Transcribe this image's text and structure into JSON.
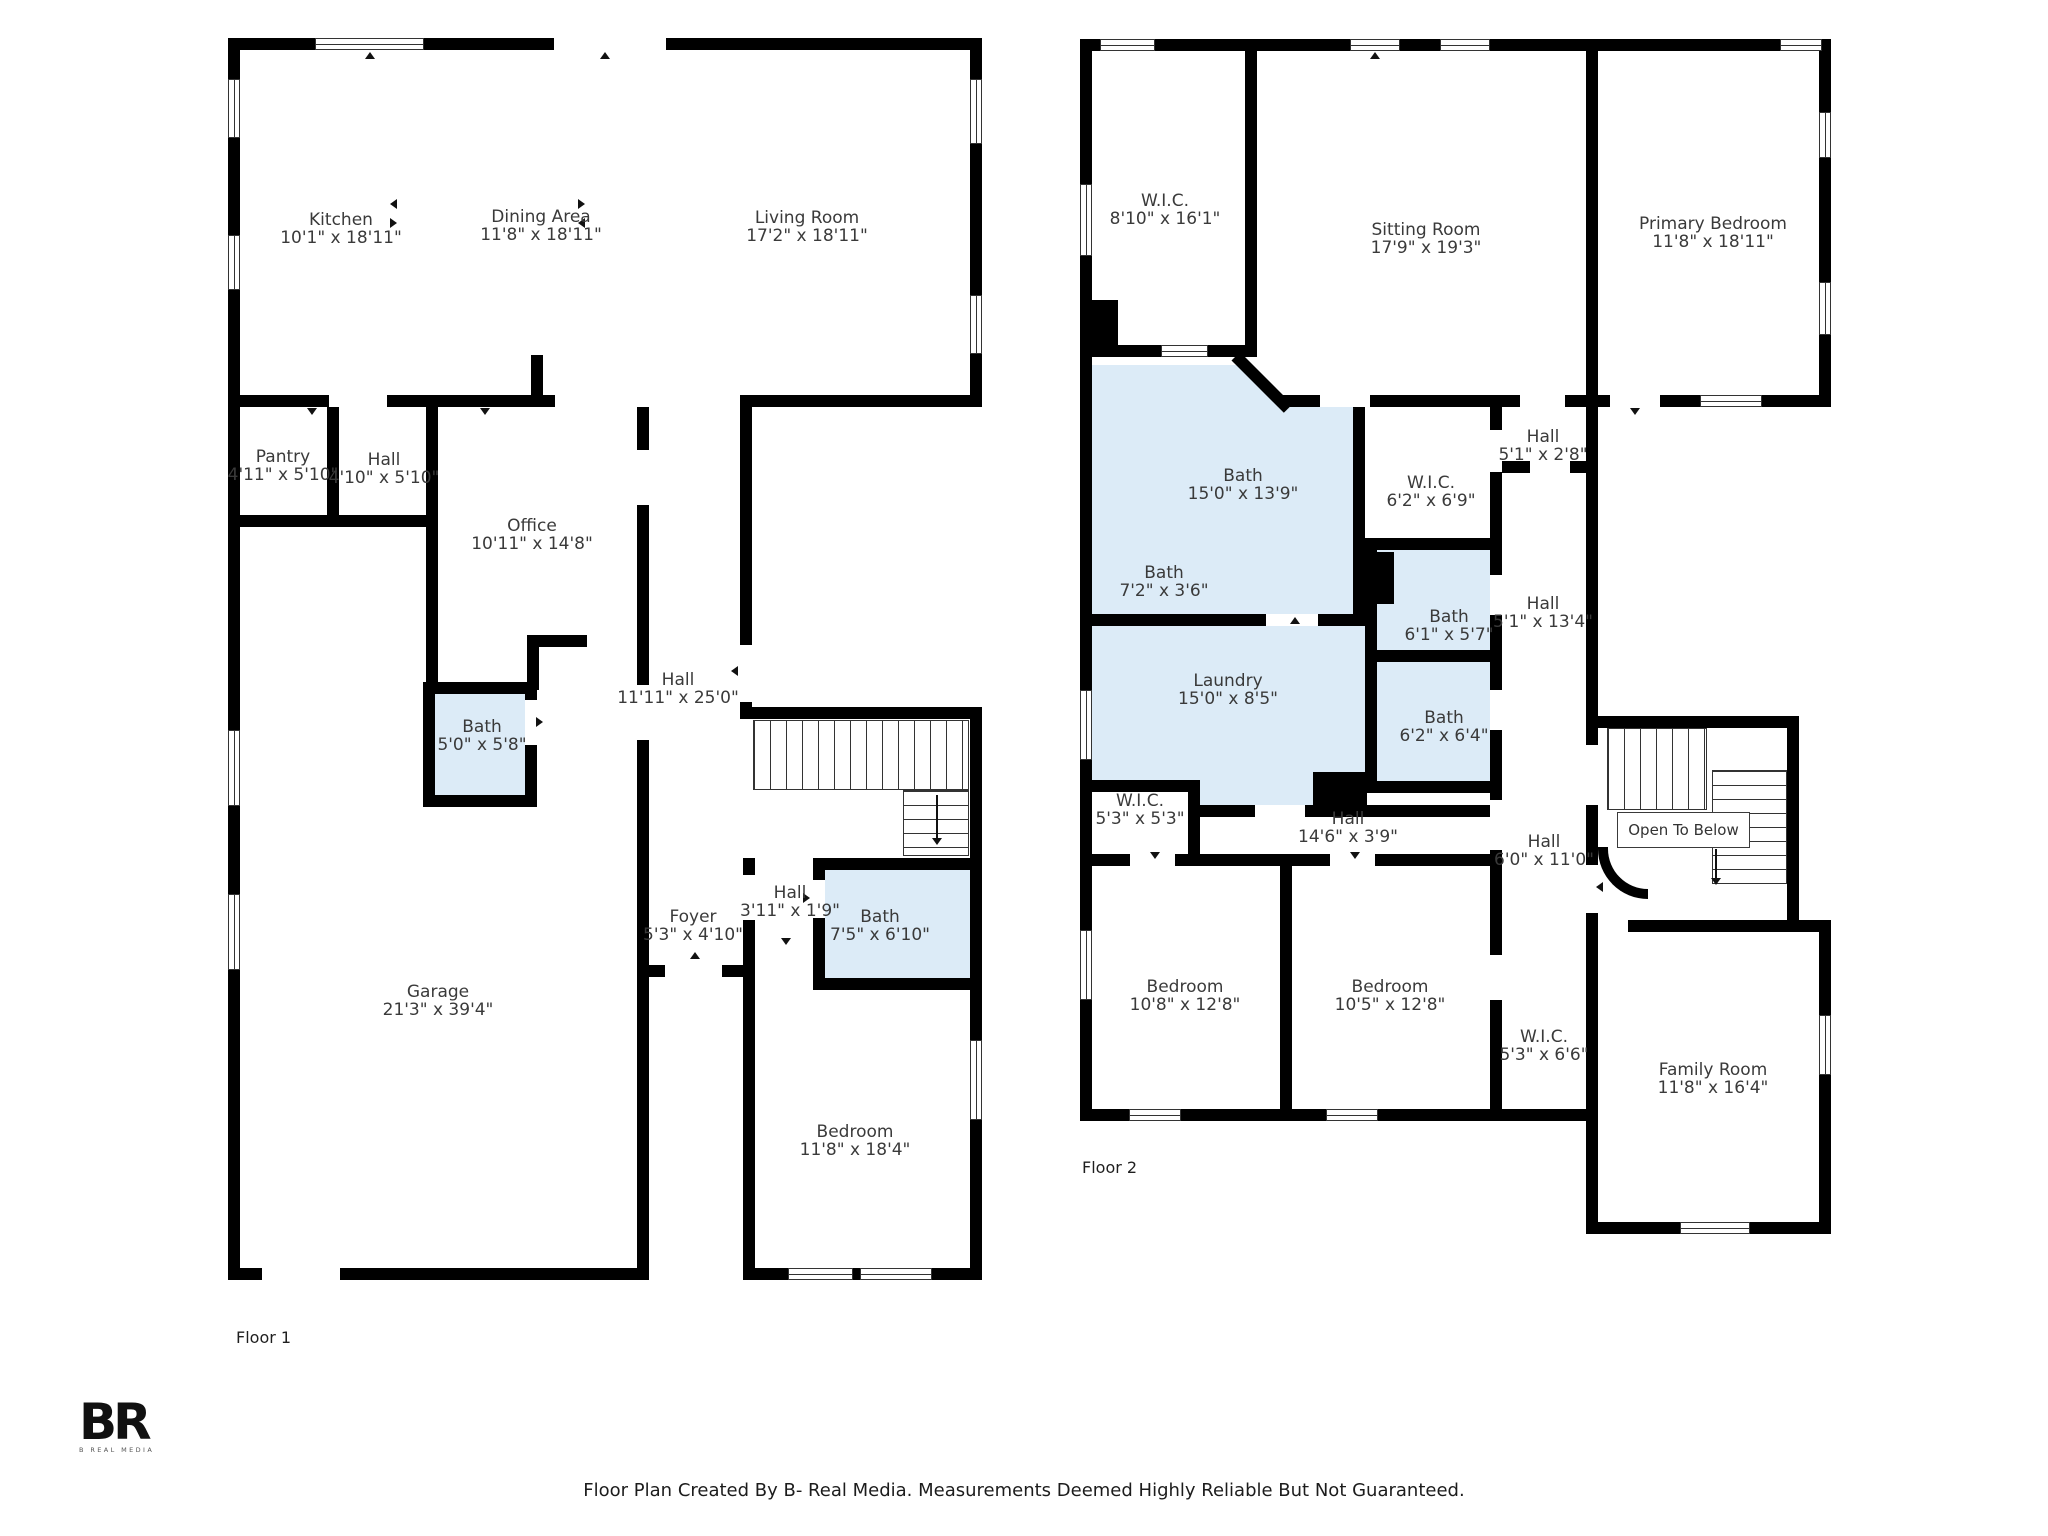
{
  "meta": {
    "footer": "Floor Plan Created By B- Real Media. Measurements Deemed Highly Reliable But Not Guaranteed.",
    "logo_text": "BR",
    "logo_subtext": "B REAL MEDIA"
  },
  "colors": {
    "wall": "#000000",
    "bath_fill": "#dcebf7",
    "text": "#3a3a3a"
  },
  "floor1": {
    "label": "Floor 1",
    "rooms": [
      {
        "name": "Kitchen",
        "dims": "10'1\" x 18'11\"",
        "x": 341,
        "y": 211
      },
      {
        "name": "Dining Area",
        "dims": "11'8\" x 18'11\"",
        "x": 541,
        "y": 208
      },
      {
        "name": "Living Room",
        "dims": "17'2\" x 18'11\"",
        "x": 807,
        "y": 209
      },
      {
        "name": "Pantry",
        "dims": "4'11\" x 5'10\"",
        "x": 283,
        "y": 448
      },
      {
        "name": "Hall",
        "dims": "4'10\" x 5'10\"",
        "x": 384,
        "y": 451
      },
      {
        "name": "Office",
        "dims": "10'11\" x 14'8\"",
        "x": 532,
        "y": 517
      },
      {
        "name": "Bath",
        "dims": "5'0\" x 5'8\"",
        "x": 482,
        "y": 718
      },
      {
        "name": "Hall",
        "dims": "11'11\" x 25'0\"",
        "x": 678,
        "y": 671
      },
      {
        "name": "Foyer",
        "dims": "5'3\" x 4'10\"",
        "x": 693,
        "y": 908
      },
      {
        "name": "Hall",
        "dims": "3'11\" x 1'9\"",
        "x": 790,
        "y": 884
      },
      {
        "name": "Bath",
        "dims": "7'5\" x 6'10\"",
        "x": 880,
        "y": 908
      },
      {
        "name": "Garage",
        "dims": "21'3\" x 39'4\"",
        "x": 438,
        "y": 983
      },
      {
        "name": "Bedroom",
        "dims": "11'8\" x 18'4\"",
        "x": 855,
        "y": 1123
      }
    ]
  },
  "floor2": {
    "label": "Floor 2",
    "open_to_below": "Open To Below",
    "rooms": [
      {
        "name": "W.I.C.",
        "dims": "8'10\" x 16'1\"",
        "x": 1165,
        "y": 192
      },
      {
        "name": "Sitting Room",
        "dims": "17'9\" x 19'3\"",
        "x": 1426,
        "y": 221
      },
      {
        "name": "Primary Bedroom",
        "dims": "11'8\" x 18'11\"",
        "x": 1713,
        "y": 215
      },
      {
        "name": "Hall",
        "dims": "5'1\" x 2'8\"",
        "x": 1543,
        "y": 428
      },
      {
        "name": "Bath",
        "dims": "15'0\" x 13'9\"",
        "x": 1243,
        "y": 467
      },
      {
        "name": "W.I.C.",
        "dims": "6'2\" x 6'9\"",
        "x": 1431,
        "y": 474
      },
      {
        "name": "Bath",
        "dims": "7'2\" x 3'6\"",
        "x": 1164,
        "y": 564
      },
      {
        "name": "Bath",
        "dims": "6'1\" x 5'7\"",
        "x": 1449,
        "y": 608
      },
      {
        "name": "Hall",
        "dims": "5'1\" x 13'4\"",
        "x": 1543,
        "y": 595
      },
      {
        "name": "Laundry",
        "dims": "15'0\" x 8'5\"",
        "x": 1228,
        "y": 672
      },
      {
        "name": "Bath",
        "dims": "6'2\" x 6'4\"",
        "x": 1444,
        "y": 709
      },
      {
        "name": "W.I.C.",
        "dims": "5'3\" x 5'3\"",
        "x": 1140,
        "y": 792
      },
      {
        "name": "Hall",
        "dims": "14'6\" x 3'9\"",
        "x": 1348,
        "y": 810
      },
      {
        "name": "Hall",
        "dims": "6'0\" x 11'0\"",
        "x": 1544,
        "y": 833
      },
      {
        "name": "Bedroom",
        "dims": "10'8\" x 12'8\"",
        "x": 1185,
        "y": 978
      },
      {
        "name": "Bedroom",
        "dims": "10'5\" x 12'8\"",
        "x": 1390,
        "y": 978
      },
      {
        "name": "W.I.C.",
        "dims": "5'3\" x 6'6\"",
        "x": 1544,
        "y": 1028
      },
      {
        "name": "Family Room",
        "dims": "11'8\" x 16'4\"",
        "x": 1713,
        "y": 1061
      }
    ]
  }
}
